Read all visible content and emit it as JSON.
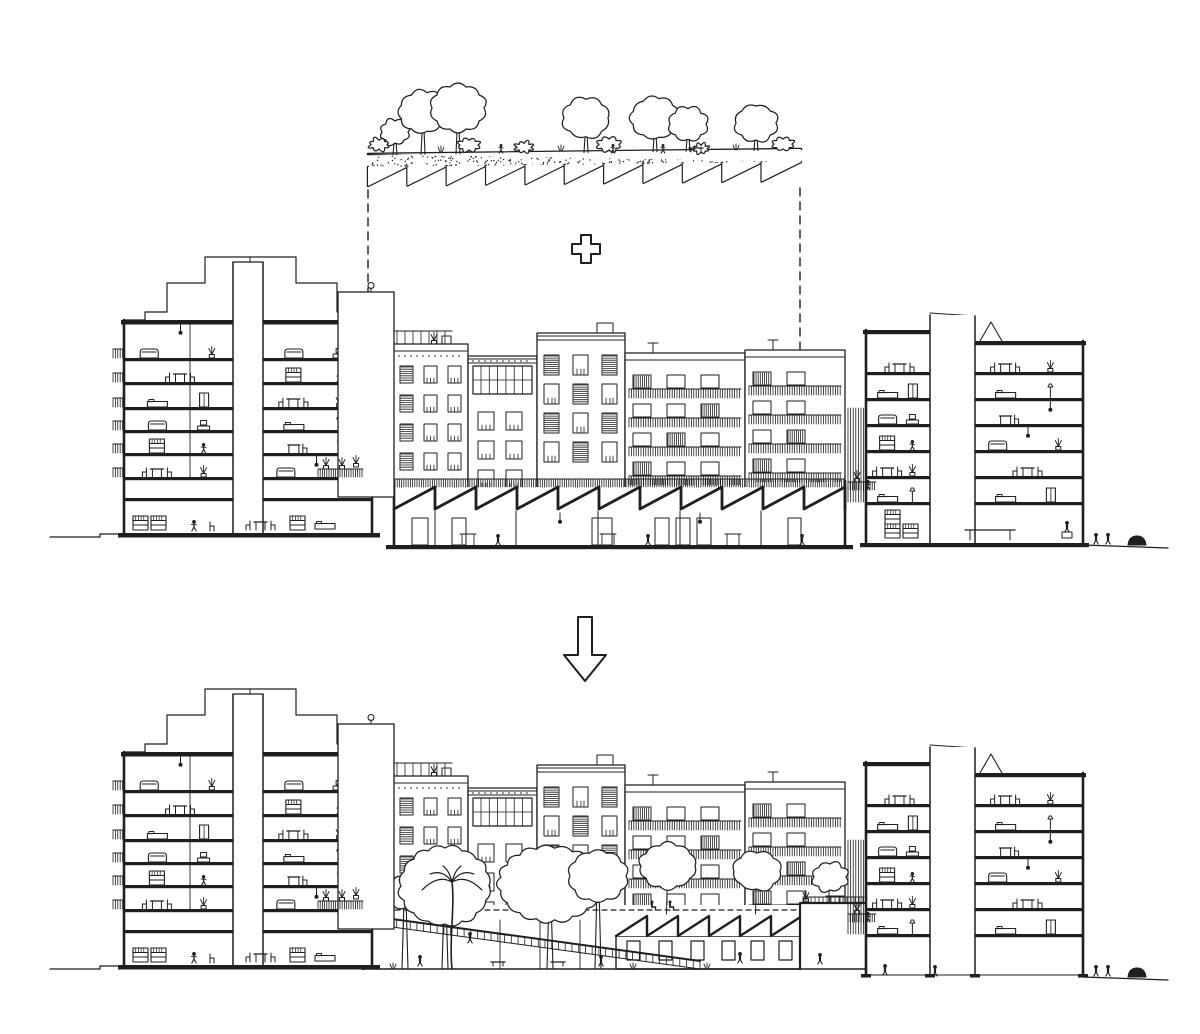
{
  "colors": {
    "ink": "#1f1f1f",
    "paper": "#ffffff"
  },
  "icons": {
    "plus": "plus-icon",
    "arrow": "arrow-down-icon",
    "lamp": "wall-lamp-icon"
  },
  "scene": {
    "canvas": {
      "w": 1200,
      "h": 1034
    },
    "green_roof": {
      "x1": 368,
      "x2": 801,
      "y_left": 154,
      "y_right": 149,
      "band_h": 13,
      "tooth_h": 19,
      "teeth": 11,
      "trees": [
        [
          395,
          132,
          13
        ],
        [
          423,
          112,
          23
        ],
        [
          458,
          108,
          26
        ],
        [
          586,
          118,
          22
        ],
        [
          655,
          118,
          23
        ],
        [
          688,
          124,
          18
        ],
        [
          756,
          123,
          20
        ]
      ],
      "bushes": [
        [
          379,
          149,
          8
        ],
        [
          469,
          150,
          9
        ],
        [
          524,
          151,
          7
        ],
        [
          609,
          150,
          10
        ],
        [
          701,
          152,
          6
        ],
        [
          783,
          149,
          9
        ]
      ],
      "figures": [
        [
          501,
          153
        ],
        [
          613,
          153
        ],
        [
          663,
          153
        ]
      ],
      "bench": [
        696,
        152
      ],
      "leader_left": {
        "x": 368,
        "y1": 190,
        "y2": 478
      },
      "leader_right": {
        "x": 800,
        "y1": 188,
        "y2": 356
      }
    },
    "plus": {
      "cx": 586,
      "cy": 249,
      "half": 14,
      "arm": 5
    },
    "arrow": {
      "cx": 585,
      "y_top": 617,
      "shaft_w": 14,
      "shaft_h": 38,
      "head_w": 42,
      "head_h": 26
    },
    "panel_dy": 432,
    "left_building": {
      "x": 124,
      "w": 248,
      "roof_y": 320,
      "floor_ys": [
        358,
        382,
        407,
        430,
        453,
        477,
        498
      ],
      "core": {
        "x": 233,
        "w": 30,
        "top": 262
      },
      "parapet": [
        [
          124,
          320
        ],
        [
          145,
          320
        ],
        [
          145,
          312
        ],
        [
          167,
          312
        ],
        [
          167,
          283
        ],
        [
          205,
          283
        ],
        [
          205,
          257
        ],
        [
          296,
          257
        ],
        [
          296,
          283
        ],
        [
          337,
          283
        ],
        [
          337,
          312
        ],
        [
          357,
          312
        ],
        [
          357,
          320
        ],
        [
          372,
          320
        ]
      ],
      "firewall": {
        "x": 338,
        "w": 56,
        "top": 292,
        "bottom": 497
      },
      "lamp": [
        371,
        288
      ],
      "base_y": 533,
      "street_y": 537,
      "terrace": {
        "x1": 318,
        "x2": 363,
        "y": 477
      },
      "left_ground": {
        "x1": 50,
        "x2": 124,
        "step_x": 100
      }
    },
    "facades": {
      "base_y": 490,
      "items": [
        {
          "x": 393,
          "w": 75,
          "top": 344,
          "style": "terrace"
        },
        {
          "x": 468,
          "w": 69,
          "top": 356,
          "style": "grid"
        },
        {
          "x": 537,
          "w": 88,
          "top": 333,
          "style": "shutter"
        },
        {
          "x": 625,
          "w": 120,
          "top": 353,
          "style": "balcony"
        },
        {
          "x": 745,
          "w": 100,
          "top": 350,
          "style": "balcony"
        }
      ]
    },
    "factory": {
      "x1": 394,
      "x2": 845,
      "fence_y": 487,
      "fence_h": 8,
      "tooth_h": 22,
      "teeth": 11,
      "floor_y": 545,
      "doors": [
        [
          412,
          16
        ],
        [
          452,
          14
        ],
        [
          592,
          20
        ],
        [
          655,
          14
        ],
        [
          676,
          14
        ],
        [
          697,
          14
        ],
        [
          788,
          13
        ]
      ],
      "columns": [
        435,
        516,
        598,
        680,
        761
      ],
      "figures": [
        [
          498,
          543
        ],
        [
          648,
          543
        ],
        [
          802,
          543
        ]
      ],
      "tables": [
        [
          468,
          541
        ],
        [
          608,
          541
        ],
        [
          733,
          541
        ]
      ]
    },
    "right_building": {
      "x": 866,
      "w": 217,
      "core": {
        "x": 930,
        "w": 45,
        "top": 313
      },
      "left_roof_y": 330,
      "left_wing_x2": 930,
      "right_roof_y": 341,
      "gable": [
        980,
        1002,
        322
      ],
      "floor_ys": [
        372,
        398,
        424,
        450,
        476,
        502
      ],
      "base_y": 543,
      "balcony_col": {
        "x": 848,
        "w": 18,
        "y1": 408,
        "y2": 502
      },
      "terrace": {
        "x1": 848,
        "x2": 876,
        "y": 490
      },
      "street": {
        "x1": 1083,
        "x2": 1168,
        "y1": 545,
        "y2": 548
      },
      "street_figures": [
        [
          1096,
          544
        ],
        [
          1108,
          544
        ]
      ],
      "bush": [
        1137,
        545
      ],
      "open_figures": [
        [
          885,
          975
        ],
        [
          935,
          976
        ]
      ]
    },
    "garden": {
      "dashed_y": 910,
      "dashed_x1": 368,
      "dashed_x2": 866,
      "wall_left": {
        "x": 363,
        "top": 905,
        "bottom": 969
      },
      "ramp": {
        "x1": 363,
        "y1": 915,
        "x2": 700,
        "y2": 961,
        "h": 8
      },
      "back_piers": [
        500,
        540,
        580
      ],
      "big_trees": [
        [
          405,
          893,
          18,
          15
        ],
        [
          445,
          886,
          44,
          38
        ],
        [
          550,
          884,
          50,
          36
        ],
        [
          598,
          876,
          28,
          24
        ]
      ],
      "palm": {
        "x": 452,
        "base_y": 969,
        "top_y": 882
      },
      "roof_trees": [
        [
          668,
          866,
          27,
          21
        ],
        [
          757,
          871,
          23,
          18
        ],
        [
          830,
          877,
          16,
          13
        ]
      ],
      "sitting_figures": [
        [
          652,
          909
        ],
        [
          670,
          909
        ]
      ],
      "benches": [
        [
          498,
          966
        ],
        [
          558,
          966
        ]
      ],
      "figures": [
        [
          382,
          912
        ],
        [
          470,
          943
        ],
        [
          420,
          966
        ],
        [
          601,
          966
        ],
        [
          740,
          963
        ],
        [
          820,
          964
        ]
      ],
      "remnant": {
        "x1": 616,
        "x2": 800,
        "tooth_w": 31,
        "roof_y": 916,
        "wall_top": 936,
        "wall_bottom": 969,
        "win_y": 941,
        "win_w": 13,
        "win_h": 19,
        "win_xs": [
          627,
          659,
          691,
          722,
          751,
          779
        ]
      },
      "terrace_wall": {
        "x1": 800,
        "x2": 866,
        "top": 903
      },
      "ground_y": 969,
      "ground_x1": 363,
      "ground_x2": 866
    }
  }
}
